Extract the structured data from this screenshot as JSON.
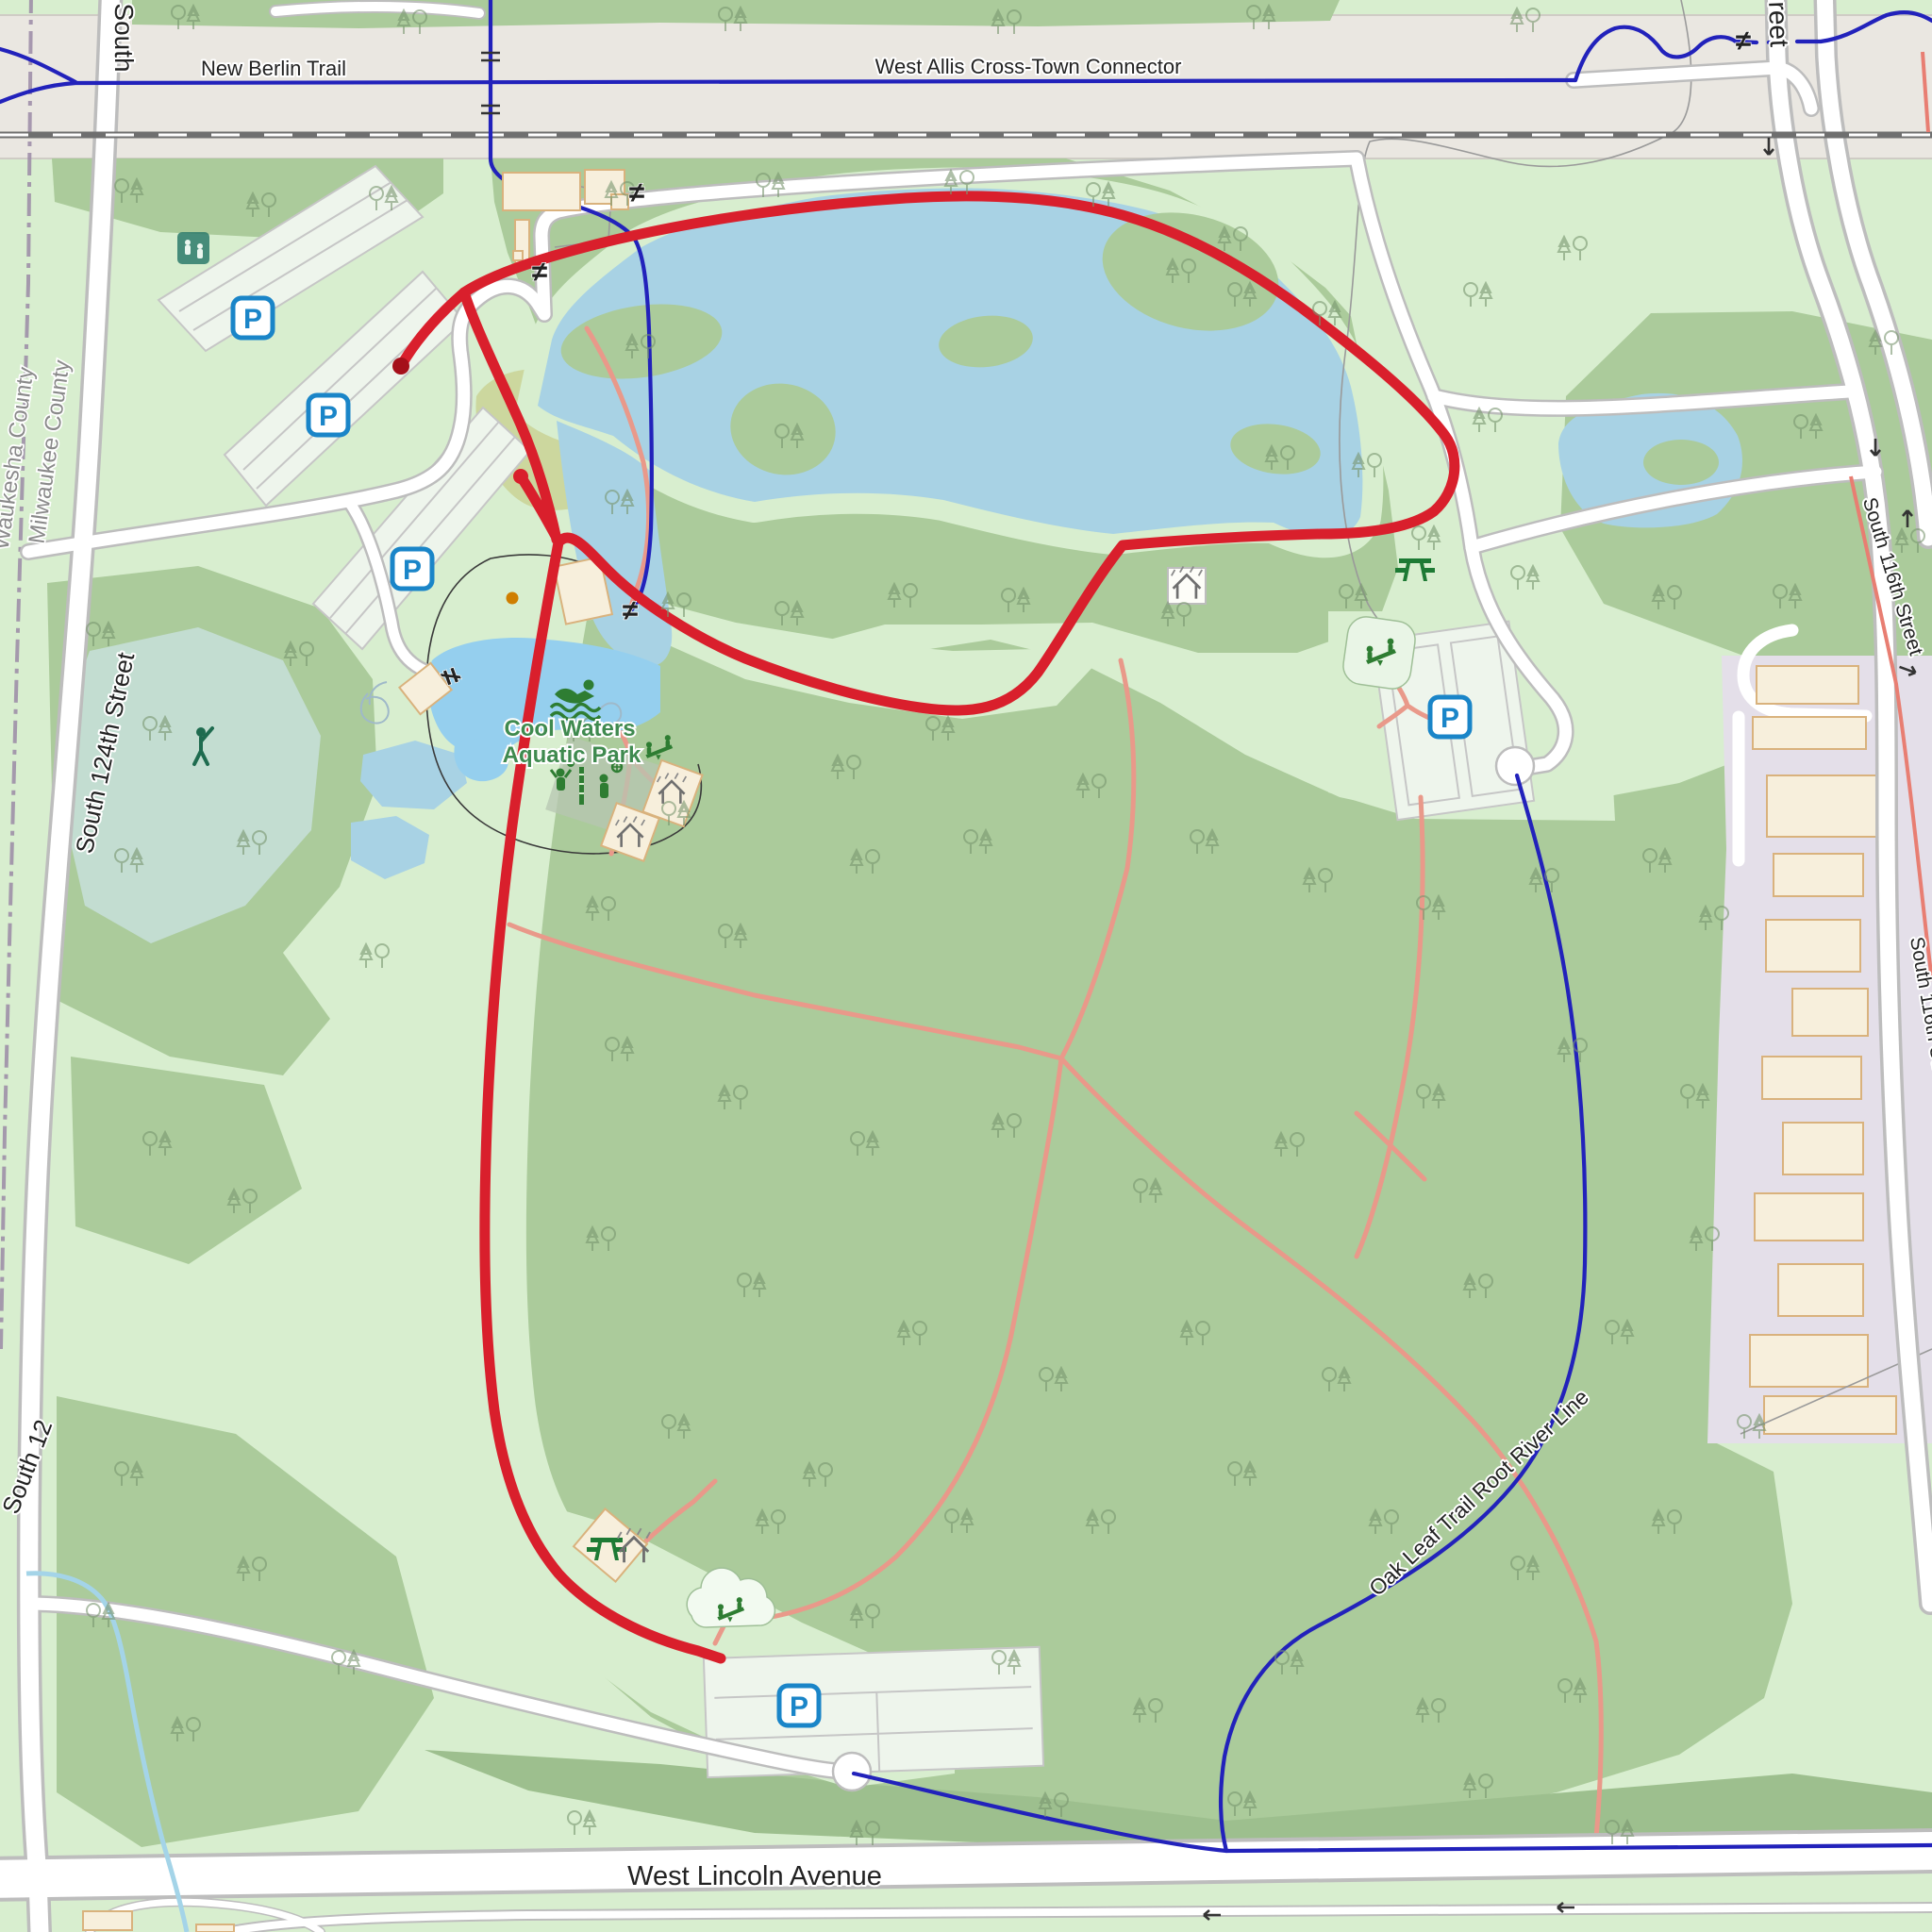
{
  "map_labels": {
    "trail_top_left": "New Berlin Trail",
    "trail_top_right": "West Allis Cross-Town Connector",
    "street_top_left_partial": "South",
    "street_top_right_partial": "reet",
    "county_left": "Waukesha County",
    "county_right": "Milwaukee County",
    "street_west": "South 124th Street",
    "street_west_partial": "South 12",
    "poi_aquatic_line1": "Cool Waters",
    "poi_aquatic_line2": "Aquatic Park",
    "street_east_upper": "South 116th Street",
    "street_east_lower": "South 116th Street",
    "trail_southeast": "Oak Leaf Trail Root River Line",
    "street_south": "West Lincoln Avenue",
    "parking_letter": "P",
    "gate_symbol": "≠"
  },
  "icons": {
    "parking-icon": "P",
    "gate-icon": "≠",
    "picnic-table-icon": "picnic table",
    "playground-icon": "seesaw playground",
    "shelter-icon": "picnic shelter",
    "swimmer-icon": "swimming",
    "volleyball-icon": "beach volleyball",
    "baseball-icon": "baseball",
    "recreation-area-icon": "recreation pitch",
    "one-way-arrow-icon": "one-way arrow",
    "route-start-marker": "route start",
    "poi-dot": "point of interest"
  },
  "colors": {
    "park_green": "#d8eecf",
    "forest_green": "#abcb9b",
    "forest_dark": "#9dbf8e",
    "water_blue": "#a8d2e4",
    "pond_teal": "#c3ddd1",
    "pool_blue": "#95cfee",
    "golf_olive": "#ccd79e",
    "corridor_gray": "#eae7e1",
    "residential_lavender": "#e4dfe9",
    "building_fill": "#f7efdc",
    "building_stroke": "#d9b27d",
    "road_casing": "#bdbdbd",
    "path_pink": "#e9998a",
    "trail_blue": "#2222bb",
    "stream_blue": "#a4d4e8",
    "route_red": "#d91f2c",
    "railway_gray": "#6f6f6f",
    "icon_green": "#2e7d32",
    "parking_blue": "#1a85c8",
    "boundary_purple": "#9b8aa6",
    "label_green": "#3f8a4f"
  }
}
